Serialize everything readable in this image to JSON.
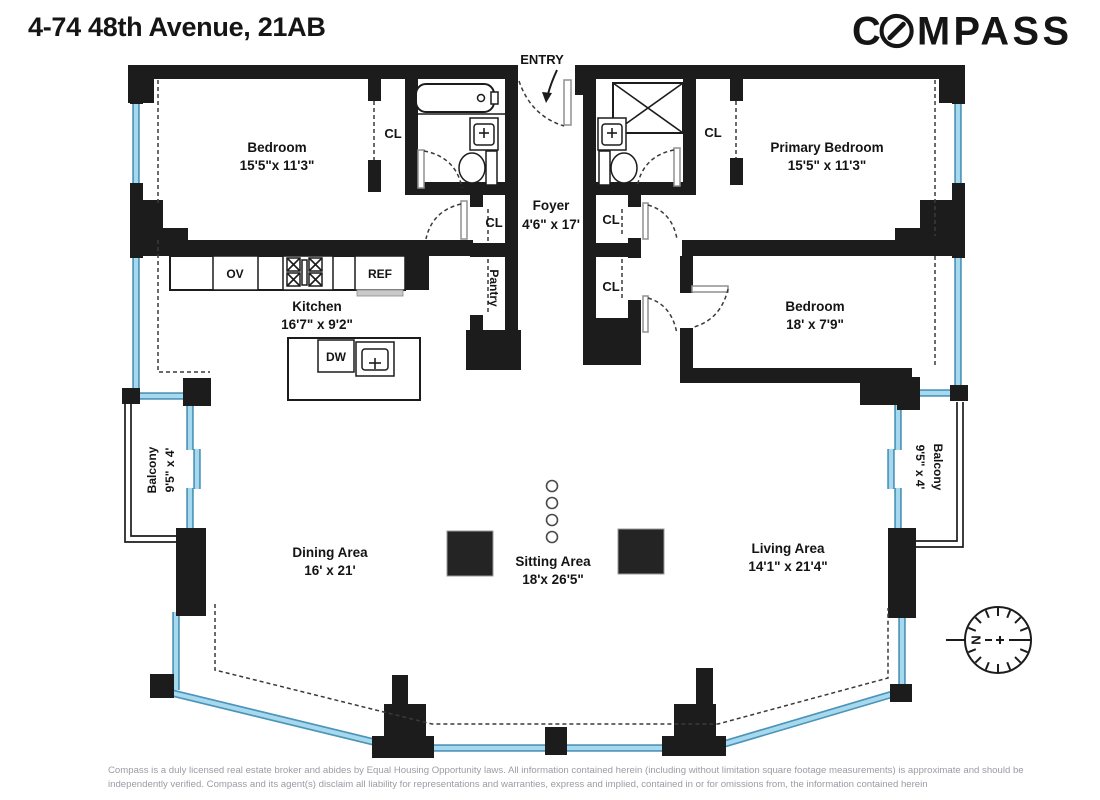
{
  "header": {
    "title": "4-74 48th Avenue, 21AB",
    "brand_first": "C",
    "brand_rest": "MPASS"
  },
  "plan": {
    "entry_label": "ENTRY",
    "closet_label": "CL",
    "pantry_label": "Pantry",
    "rooms": {
      "bedroom_top_left": {
        "name": "Bedroom",
        "dims": "15'5\"x 11'3\""
      },
      "primary_bedroom": {
        "name": "Primary Bedroom",
        "dims": "15'5\" x 11'3\""
      },
      "bedroom_right": {
        "name": "Bedroom",
        "dims": "18' x 7'9\""
      },
      "foyer": {
        "name": "Foyer",
        "dims": "4'6\" x 17'"
      },
      "kitchen": {
        "name": "Kitchen",
        "dims": "16'7\" x 9'2\""
      },
      "dining_area": {
        "name": "Dining Area",
        "dims": "16' x 21'"
      },
      "sitting_area": {
        "name": "Sitting Area",
        "dims": "18'x 26'5\""
      },
      "living_area": {
        "name": "Living Area",
        "dims": "14'1\" x 21'4\""
      },
      "balcony_left": {
        "name": "Balcony",
        "dims": "9'5\" x 4'"
      },
      "balcony_right": {
        "name": "Balcony",
        "dims": "9'5\" x 4'"
      }
    },
    "appliances": {
      "oven": "OV",
      "refrigerator": "REF",
      "dishwasher": "DW"
    },
    "compass_rose_north": "N"
  },
  "footer": {
    "disclaimer_line1": "Compass is a duly licensed real estate broker and abides by Equal Housing Opportunity laws.  All information contained herein (including without limitation square footage measurements) is approximate and should be",
    "disclaimer_line2": "independently verified. Compass and its agent(s) disclaim all liability for representations and warranties, express and implied, contained in or for omissions from, the information contained herein"
  },
  "colors": {
    "wall": "#1c1c1c",
    "glass_core": "#a6d9ee",
    "glass_edge": "#4d94b8",
    "disclaimer_text": "#9b9ba4"
  }
}
